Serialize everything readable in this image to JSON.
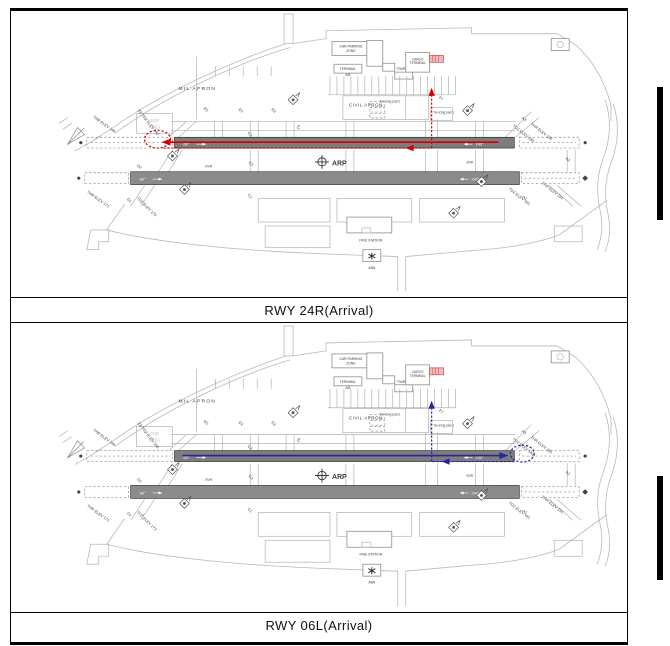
{
  "panels": [
    {
      "caption": "RWY 24R(Arrival)",
      "route": "red"
    },
    {
      "caption": "RWY 06L(Arrival)",
      "route": "blue"
    }
  ],
  "colors": {
    "route_red": "#d40000",
    "route_blue": "#26269b",
    "runway_main": "#7d7d7d",
    "runway_secondary": "#8b8b8b"
  },
  "map": {
    "mil_apron": "MIL APRON",
    "car_parking_1": "CAR PARKING",
    "car_parking_2": "ZONE",
    "terminal": "TERMINAL",
    "terminal_ab": "A/B",
    "twr": "TWR",
    "cargo_1": "CARGO",
    "cargo_2": "TERMINAL",
    "civil_apron": "CIVIL APRON",
    "deicing2": "De-icing pad 2",
    "deicing1": "De-icing pad 1",
    "sod_1": "SOD",
    "sod_2": "AREA",
    "arp": "ARP",
    "fire_station": "FIRE STATION",
    "abn": "ABN",
    "rvr": "RVR",
    "twy_e": "E",
    "e7": "E7",
    "e6_tdz": "E6 TDZ ELEV 160",
    "e5": "E5",
    "e4": "E4",
    "e3": "E3",
    "c3": "C3",
    "c2": "C2",
    "c1": "C1",
    "d2": "D2",
    "d1": "D1",
    "a3": "A3",
    "a2": "A2",
    "a1": "A1",
    "thr146": "THR ELEV 146",
    "thr171": "THR ELEV 171",
    "tdz173": "TDZ ELEV 173",
    "thr185": "THR ELEV 185",
    "tdz183": "TDZ ELEV 183",
    "thr191": "THR ELEV 191",
    "tdz191": "TDZ ELEV 191",
    "hdg_w": "60°",
    "hdg_e": "240°"
  }
}
